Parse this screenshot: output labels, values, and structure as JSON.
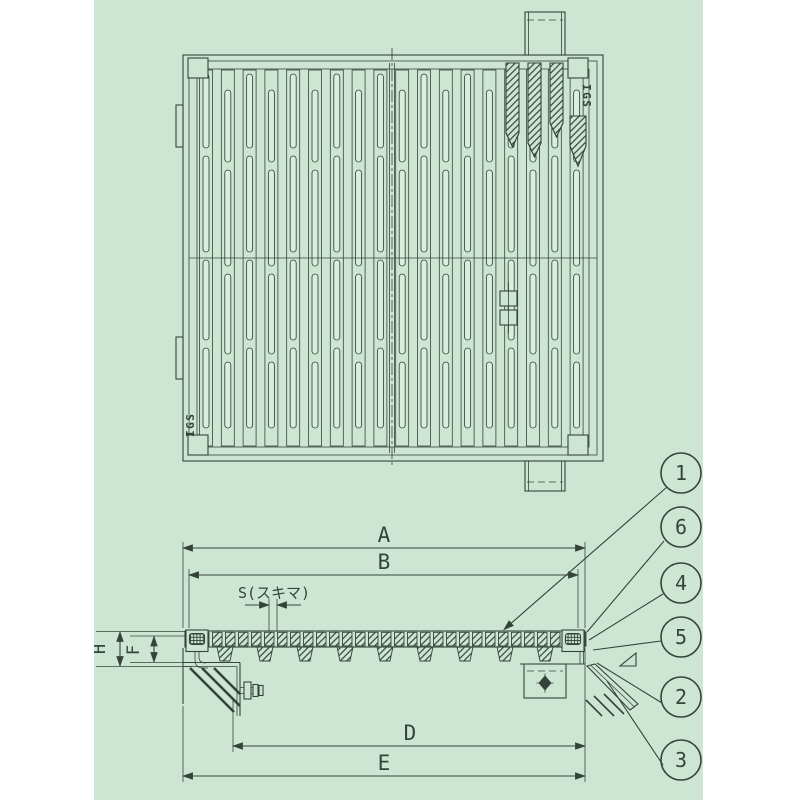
{
  "colors": {
    "paper": "#cde6d4",
    "ink": "#35443b",
    "slot": "#daeede"
  },
  "plan": {
    "logo_top_right": "IGS",
    "logo_bottom_left": "IGS"
  },
  "section": {
    "dim_a": "A",
    "dim_b": "B",
    "dim_d": "D",
    "dim_e": "E",
    "dim_h": "H",
    "dim_f": "F",
    "dim_s": "S(スキマ)"
  },
  "callouts": [
    {
      "n": "1"
    },
    {
      "n": "6"
    },
    {
      "n": "4"
    },
    {
      "n": "5"
    },
    {
      "n": "2"
    },
    {
      "n": "3"
    }
  ]
}
